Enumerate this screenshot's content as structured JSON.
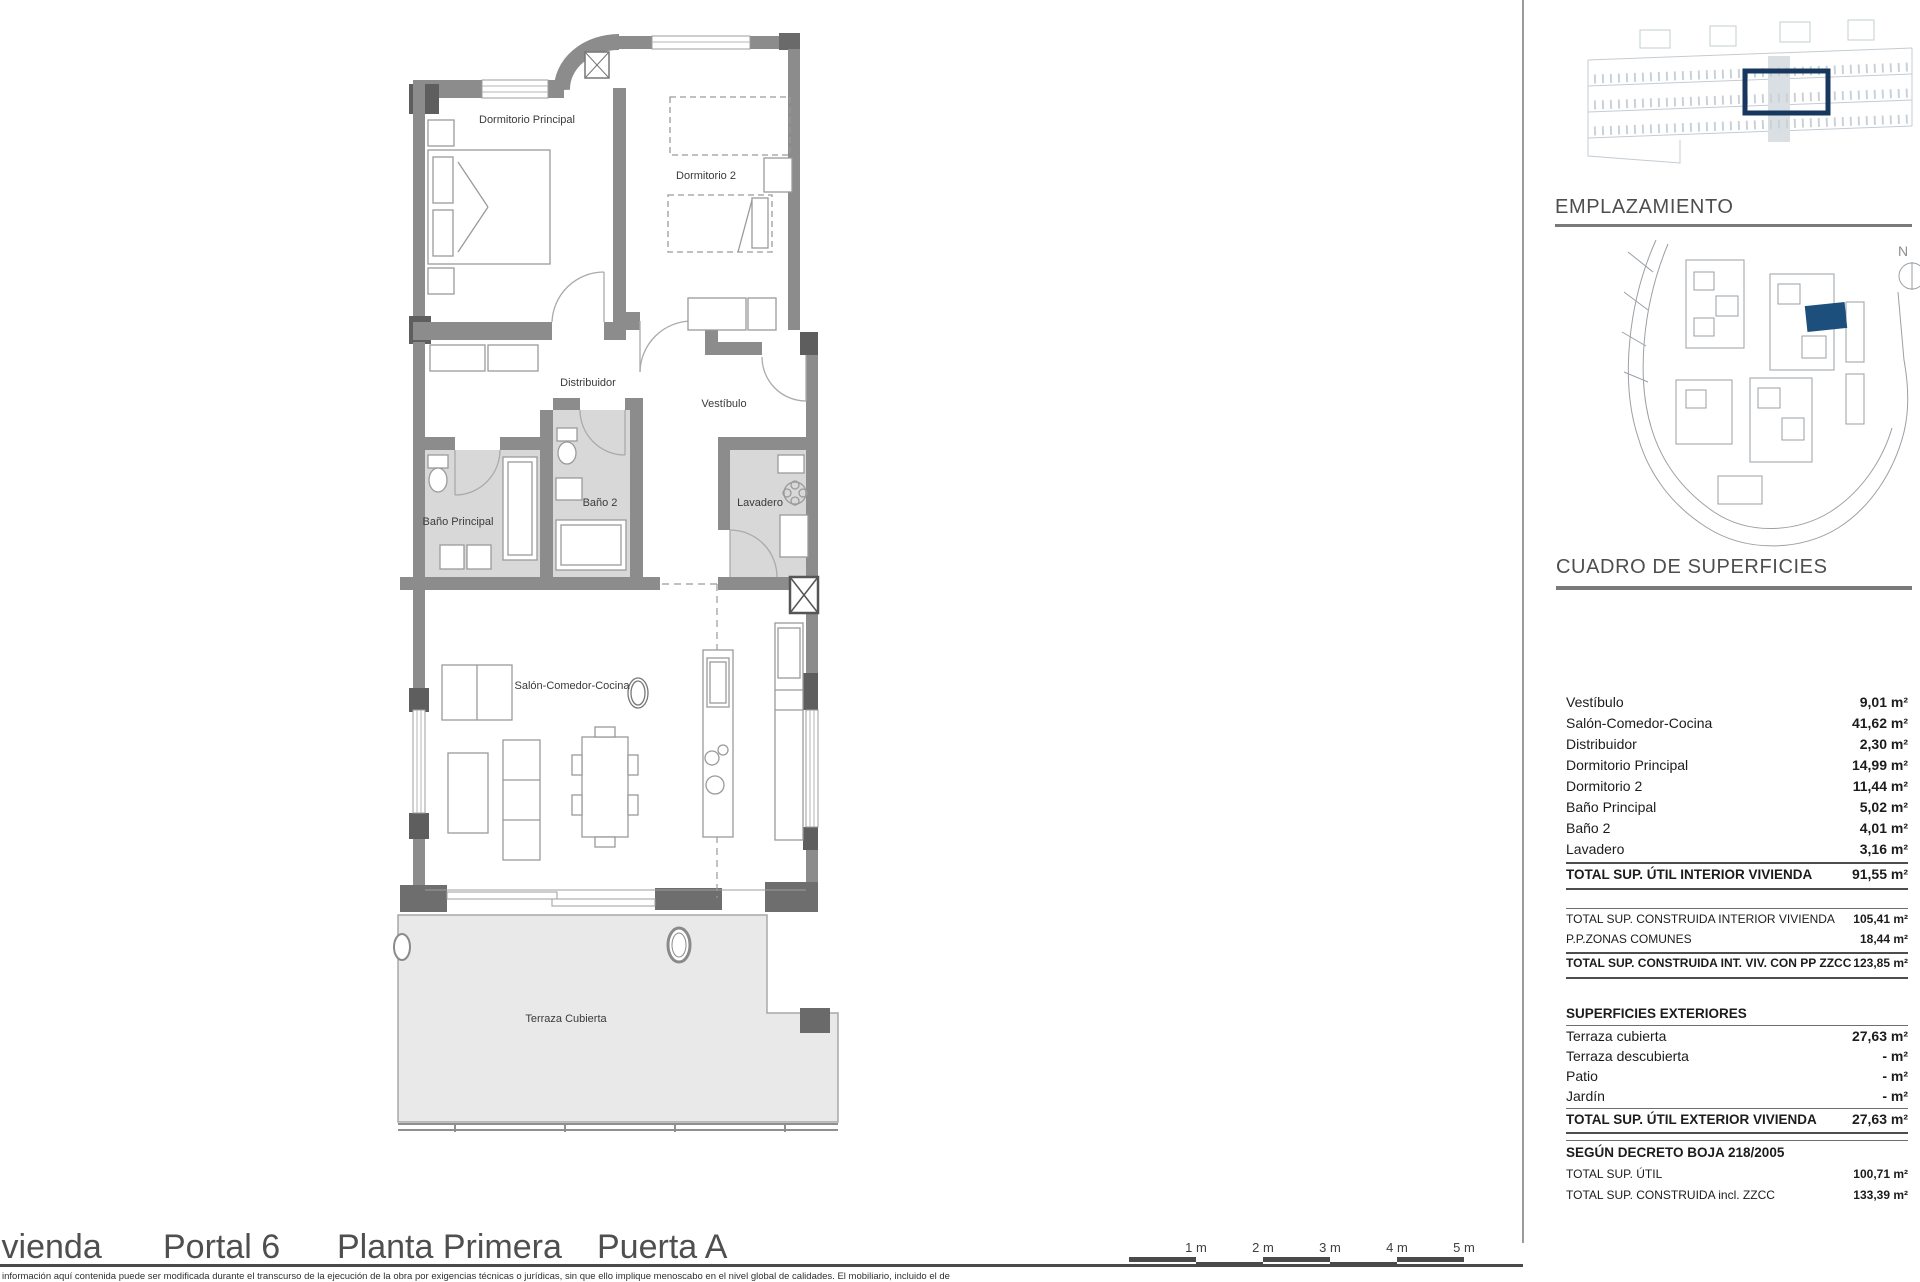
{
  "plan": {
    "room_labels": {
      "dormitorio_principal": "Dormitorio Principal",
      "dormitorio_2": "Dormitorio 2",
      "distribuidor": "Distribuidor",
      "vestibulo": "Vestíbulo",
      "bano_principal": "Baño Principal",
      "bano_2": "Baño 2",
      "lavadero": "Lavadero",
      "salon": "Salón-Comedor-Cocina",
      "terraza": "Terraza Cubierta"
    }
  },
  "sidebar": {
    "emplazamiento_title": "EMPLAZAMIENTO",
    "north_label": "N",
    "surfaces_title": "CUADRO DE SUPERFICIES",
    "interior": [
      {
        "label": "Vestíbulo",
        "value": "9,01 m²"
      },
      {
        "label": "Salón-Comedor-Cocina",
        "value": "41,62 m²"
      },
      {
        "label": "Distribuidor",
        "value": "2,30 m²"
      },
      {
        "label": "Dormitorio Principal",
        "value": "14,99 m²"
      },
      {
        "label": "Dormitorio 2",
        "value": "11,44 m²"
      },
      {
        "label": "Baño Principal",
        "value": "5,02 m²"
      },
      {
        "label": "Baño 2",
        "value": "4,01 m²"
      },
      {
        "label": "Lavadero",
        "value": "3,16 m²"
      }
    ],
    "interior_total": {
      "label": "TOTAL SUP. ÚTIL INTERIOR VIVIENDA",
      "value": "91,55 m²"
    },
    "construida": [
      {
        "label": "TOTAL SUP. CONSTRUIDA INTERIOR VIVIENDA",
        "value": "105,41 m²"
      },
      {
        "label": "P.P.ZONAS COMUNES",
        "value": "18,44 m²"
      }
    ],
    "construida_total": {
      "label": "TOTAL SUP. CONSTRUIDA INT. VIV. CON PP ZZCC",
      "value": "123,85 m²"
    },
    "exterior_header": "SUPERFICIES EXTERIORES",
    "exterior": [
      {
        "label": "Terraza cubierta",
        "value": "27,63 m²"
      },
      {
        "label": "Terraza descubierta",
        "value": "- m²"
      },
      {
        "label": "Patio",
        "value": "- m²"
      },
      {
        "label": "Jardín",
        "value": "- m²"
      }
    ],
    "exterior_total": {
      "label": "TOTAL SUP. ÚTIL EXTERIOR VIVIENDA",
      "value": "27,63 m²"
    },
    "decreto_header": "SEGÚN DECRETO BOJA 218/2005",
    "decreto": [
      {
        "label": "TOTAL SUP. ÚTIL",
        "value": "100,71 m²"
      },
      {
        "label": "TOTAL SUP. CONSTRUIDA incl. ZZCC",
        "value": "133,39 m²"
      }
    ]
  },
  "footer": {
    "title_parts": [
      "ivienda",
      "Portal 6",
      "Planta Primera",
      "Puerta A"
    ],
    "scale_labels": [
      "1 m",
      "2 m",
      "3 m",
      "4 m",
      "5 m"
    ],
    "disclaimer": "información aquí contenida puede ser modificada durante el transcurso de la ejecución de la obra por exigencias técnicas o jurídicas, sin que ello implique menoscabo en el nivel global de calidades. El mobiliario, incluido el de"
  },
  "colors": {
    "highlight_blue": "#17375e",
    "wall_gray": "#8c8c8c",
    "wet_floor_gray": "#d8d8d8",
    "terrace_gray": "#e9e9e9"
  }
}
